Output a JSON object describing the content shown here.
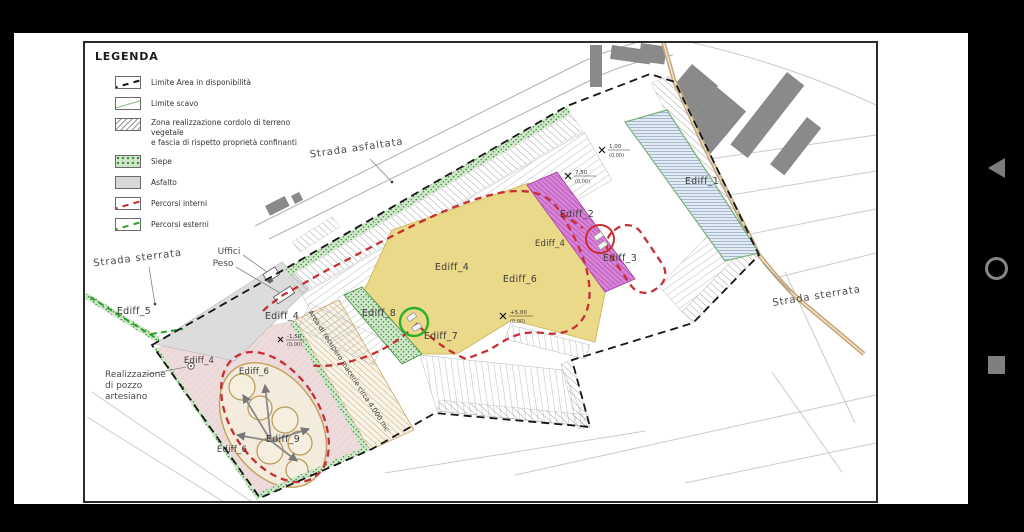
{
  "legend": {
    "title": "LEGENDA",
    "items": [
      {
        "label": "Limite Area in disponibilità",
        "swatch": "dashed-black-line"
      },
      {
        "label": "Limite scavo",
        "swatch": "green-line"
      },
      {
        "label": "Zona realizzazione cordolo di terreno vegetale",
        "label2": "e fascia di rispetto proprietà confinanti",
        "swatch": "gray-hatch"
      },
      {
        "label": "Siepe",
        "swatch": "green-speckle"
      },
      {
        "label": "Asfalto",
        "swatch": "gray-fill"
      },
      {
        "label": "Percorsi interni",
        "swatch": "red-dashed-line"
      },
      {
        "label": "Percorsi esterni",
        "swatch": "green-dashed-line"
      }
    ]
  },
  "plan": {
    "roads": {
      "asfaltata": "Strada asfaltata",
      "sterrata_left": "Strada sterrata",
      "sterrata_right": "Strada sterrata"
    },
    "buildings": {
      "e1": "Ediff_1",
      "e2": "Ediff_2",
      "e3": "Ediff_3",
      "e4": "Ediff_4",
      "e5": "Ediff_5",
      "e6": "Ediff_6",
      "e7": "Ediff_7",
      "e8": "Ediff_8",
      "e9": "Ediff_9"
    },
    "annotations": {
      "uffici": "Uffici",
      "peso": "Peso",
      "pozzo_line1": "Realizzazione",
      "pozzo_line2": "di pozzo",
      "pozzo_line3": "artesiano",
      "area_recupero": "Area di recupero macerie circa 4.000 mc"
    },
    "elevation_markers": [
      {
        "value": "1,00",
        "datum": "(0,00)"
      },
      {
        "value": "7,50",
        "datum": "(0,00)"
      },
      {
        "value": "+5,00",
        "datum": "(0,00)"
      },
      {
        "value": "-1,50",
        "datum": "(0,00)"
      }
    ]
  },
  "colors": {
    "ediff_1_fill": "#e2eaf3",
    "ediff_2_fill": "#d883d8",
    "ediff_6_fill": "#ead988",
    "ediff_8_fill": "#8cc584",
    "asphalt": "#dcdcdc",
    "pink_zone": "#eedcdc",
    "internal_path": "#c62f33",
    "external_path": "#2aa22a",
    "boundary": "#161616",
    "dirt_road": "#c9a87b"
  },
  "navbar": {
    "icons": [
      "back-icon",
      "home-icon",
      "recents-icon"
    ]
  }
}
